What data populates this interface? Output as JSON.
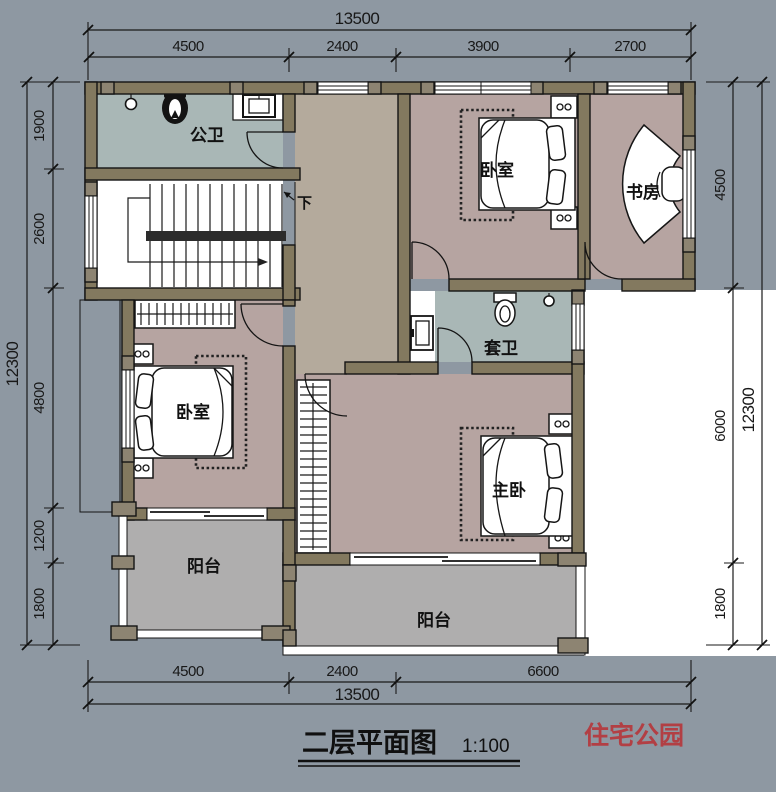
{
  "title": {
    "text": "二层平面图",
    "scale": "1:100"
  },
  "watermark": {
    "text": "住宅公园"
  },
  "dimensions": {
    "top": {
      "total": "13500",
      "segments": [
        "4500",
        "2400",
        "3900",
        "2700"
      ]
    },
    "bottom": {
      "total": "13500",
      "segments": [
        "4500",
        "2400",
        "6600"
      ]
    },
    "left": {
      "total": "12300",
      "segments": [
        "1900",
        "2600",
        "4800",
        "1200",
        "1800"
      ]
    },
    "right": {
      "total": "12300",
      "segments": [
        "4500",
        "6000",
        "1800"
      ]
    }
  },
  "rooms": {
    "public_bath": {
      "label": "公卫"
    },
    "bedroom_top": {
      "label": "卧室"
    },
    "study": {
      "label": "书房"
    },
    "ensuite_bath": {
      "label": "套卫"
    },
    "bedroom_left": {
      "label": "卧室"
    },
    "master_bedroom": {
      "label": "主卧"
    },
    "balcony_left": {
      "label": "阳台"
    },
    "balcony_bottom": {
      "label": "阳台"
    }
  },
  "stairs": {
    "direction_label": "下"
  },
  "colors": {
    "background": "#8e98a2",
    "wall": "#83795f",
    "pier": "#8d8472",
    "bath_floor": "#a9b7b6",
    "bedroom_floor": "#b6a4a1",
    "hall_floor": "#b4aa9c",
    "balcony_floor": "#afaeae",
    "cutout": "#ffffff",
    "watermark_red": "#b23f44"
  }
}
